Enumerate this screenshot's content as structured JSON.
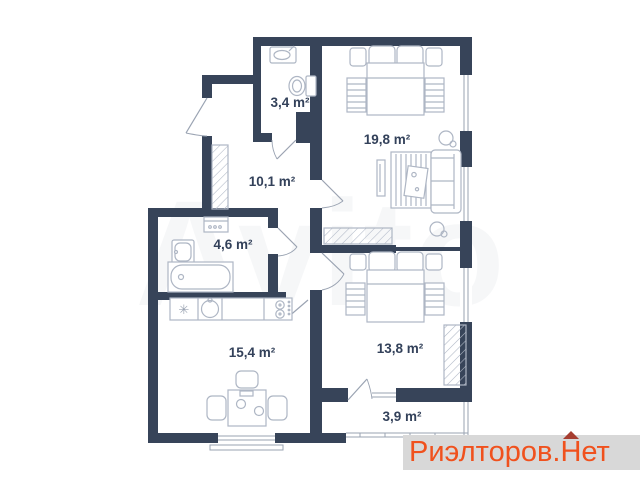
{
  "plan": {
    "rooms": [
      {
        "name": "wc",
        "label": "3,4 m²"
      },
      {
        "name": "bedroom-main",
        "label": "19,8 m²"
      },
      {
        "name": "hallway",
        "label": "10,1 m²"
      },
      {
        "name": "bathroom",
        "label": "4,6 m²"
      },
      {
        "name": "kitchen-living",
        "label": "15,4 m²"
      },
      {
        "name": "bedroom-second",
        "label": "13,8 m²"
      },
      {
        "name": "balcony",
        "label": "3,9 m²"
      }
    ],
    "colors": {
      "wall": "#374459",
      "furniture_line": "#aeb6c4",
      "label_text": "#33415a",
      "background": "#ffffff"
    }
  },
  "watermarks": {
    "center_text": "Avito",
    "brand": {
      "prefix": "Риэлторов.",
      "roofed_letter": "Н",
      "suffix": "ет",
      "text_color": "#f0511d",
      "roof_color": "#a63d30",
      "band_color": "#d8d8d8"
    }
  }
}
